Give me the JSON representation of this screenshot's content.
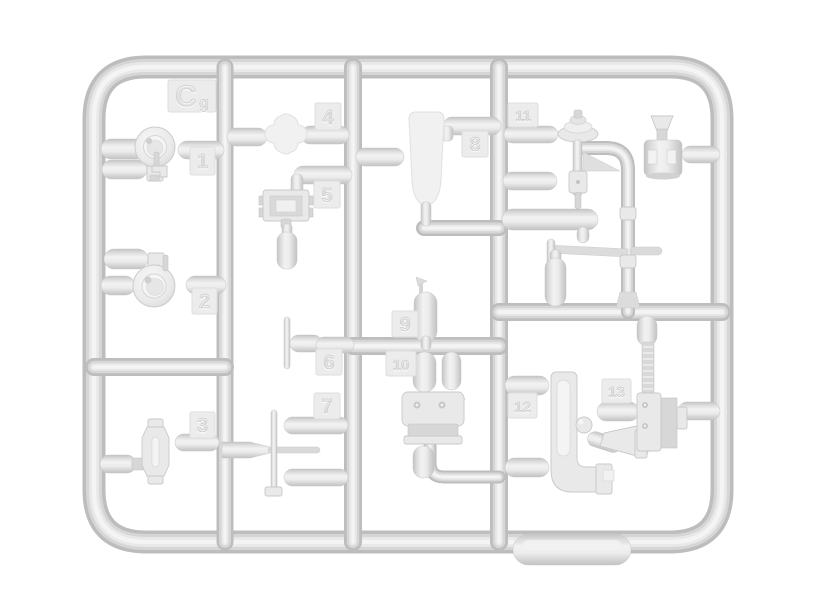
{
  "page": {
    "background": "#ffffff"
  },
  "sprue": {
    "id_label": "C",
    "id_sublabel": "g",
    "plastic_colors": {
      "edge": "#bdbdbd",
      "mid": "#d6d6d6",
      "light": "#e8e8e8",
      "highlight": "#f4f4f4",
      "tile": "#ececec",
      "numeral": "#dcdcdc"
    },
    "part_labels": [
      "1",
      "2",
      "3",
      "4",
      "5",
      "6",
      "7",
      "8",
      "9",
      "10",
      "11",
      "12",
      "13"
    ]
  }
}
